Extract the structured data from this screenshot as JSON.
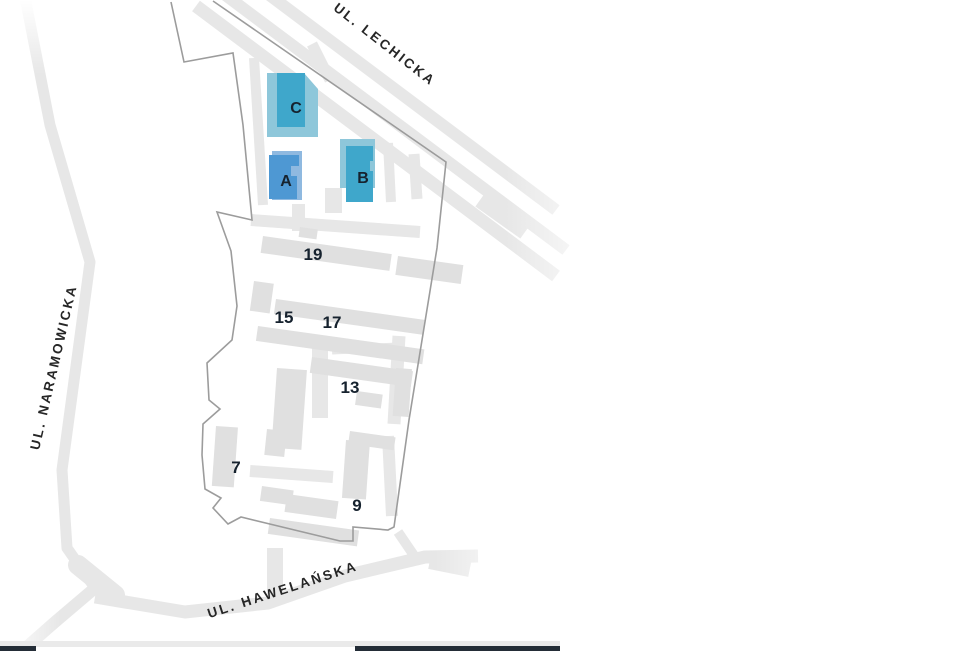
{
  "map": {
    "streets": [
      {
        "name": "UL. LECHICKA"
      },
      {
        "name": "UL. NARAMOWICKA"
      },
      {
        "name": "UL. HAWELAŃSKA"
      }
    ],
    "highlighted_buildings": [
      {
        "label": "A",
        "fill": "#4E98D3",
        "back_fill": "#8FB9E0"
      },
      {
        "label": "B",
        "fill": "#3FA7CB",
        "back_fill": "#8EC7DA"
      },
      {
        "label": "C",
        "fill": "#3FA7CB",
        "back_fill": "#8EC7DA"
      }
    ],
    "numbered_buildings": [
      {
        "label": "19"
      },
      {
        "label": "15"
      },
      {
        "label": "17"
      },
      {
        "label": "13"
      },
      {
        "label": "7"
      },
      {
        "label": "9"
      }
    ],
    "colors": {
      "road": "#E7E7E7",
      "building": "#E0E0E0",
      "boundary": "#9C9C9C",
      "label_text": "#16222E",
      "street_text": "#262626"
    }
  },
  "bottom_bar": {
    "divider_color": "#EAEAEA",
    "dark_color": "#242D37"
  }
}
